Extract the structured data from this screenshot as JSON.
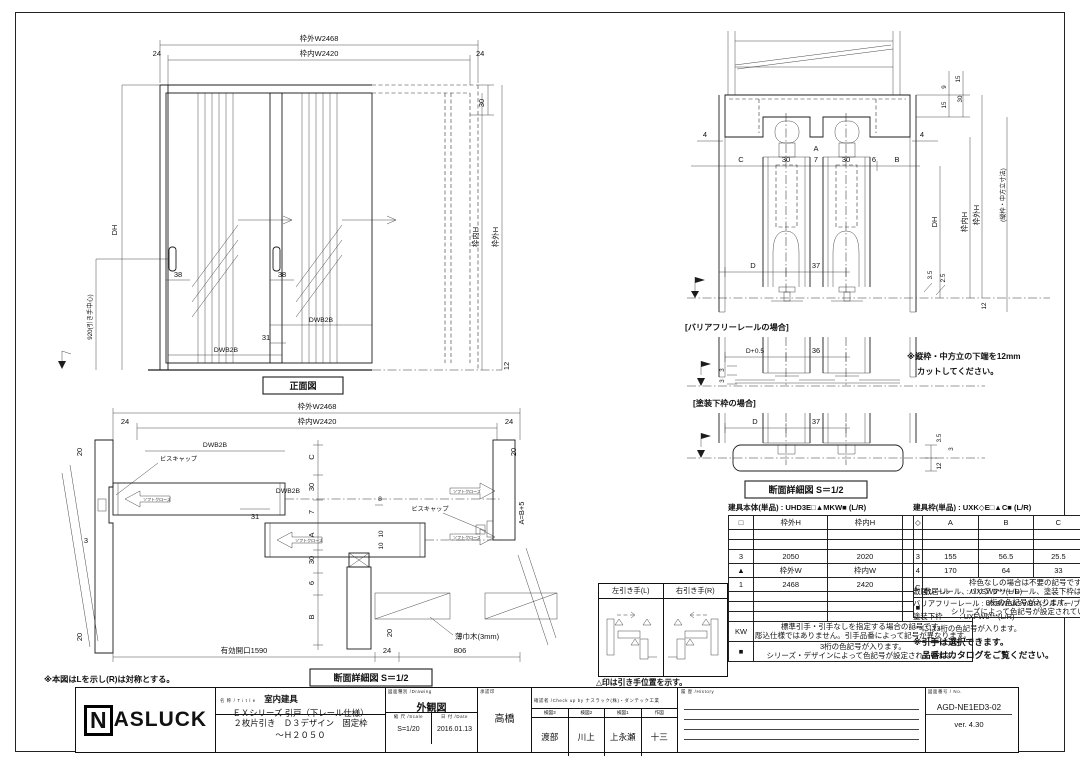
{
  "front": {
    "caption": "正面図",
    "dims": {
      "outer_w": "枠外W2468",
      "inner_w": "枠内W2420",
      "s24": "24",
      "s30": "30",
      "s12": "12",
      "dh": "DH",
      "pull": "920(引き手中心)",
      "s38": "38",
      "s31": "31",
      "dwb": "DWB2B",
      "uchi_h": "枠内H",
      "soto_h": "枠外H"
    }
  },
  "plan": {
    "caption": "断面詳細図 S＝1/2",
    "note": "※本図はLを示し(R)は対称とする。",
    "dims": {
      "outer_w": "枠外W2468",
      "inner_w": "枠内W2420",
      "s24": "24",
      "s20": "20",
      "s3": "3",
      "s31": "31",
      "s8": "8",
      "s10": "10",
      "dwb": "DWB2B",
      "c": "C",
      "t30": "30",
      "t7": "7",
      "a": "A",
      "t6": "6",
      "b": "B",
      "rel": "A=B+5",
      "open": "有効開口1590",
      "s806": "806"
    },
    "labels": {
      "cap": "ビスキャップ",
      "soft": "ソフトクローズ",
      "base": "薄巾木(3mm)"
    }
  },
  "section": {
    "caption": "断面詳細図 S＝1/2",
    "case1": "[バリアフリーレールの場合]",
    "case2": "[塗装下枠の場合]",
    "note1": "※縦枠・中方立の下端を12mm",
    "note2": "カットしてください。",
    "dims": {
      "s9": "9",
      "s15": "15",
      "s30": "30",
      "s4": "4",
      "c": "C",
      "t7": "7",
      "t6": "6",
      "a": "A",
      "b": "B",
      "dh": "DH",
      "uchi_h": "枠内H",
      "soto_h": "枠外H",
      "tate": "(縦枠・中方立寸法)",
      "d": "D",
      "s37": "37",
      "s25": "2.5",
      "s35": "3.5",
      "s12": "12",
      "d05": "D+0.5",
      "s36": "36",
      "s3": "3"
    }
  },
  "handles": {
    "left": "左引き手(L)",
    "right": "右引き手(R)",
    "caption": "△印は引き手位置を示す。"
  },
  "table_a": {
    "title": "建具本体(単品) : UHD3E□▲MKW■ (L/R)",
    "headers": [
      "□",
      "枠外H",
      "枠内H",
      "ＤＨ"
    ],
    "r3": [
      "3",
      "2050",
      "2020",
      "2020"
    ],
    "r4": [
      "▲",
      "枠外W",
      "枠内W",
      "ＤＷ"
    ],
    "r5": [
      "1",
      "2468",
      "2420",
      "826"
    ],
    "kw": "KW",
    "kw_note1": "標準引手・引手なしを指定する場合の記号です。",
    "kw_note2": "彫込仕様ではありません。引手品番によって記号が異なります。",
    "sq": "■",
    "sq_note1": "3桁の色記号が入ります。",
    "sq_note2": "シリーズ・デザインによって色記号が設定されています。"
  },
  "table_b": {
    "title": "建具枠(単品) : UXK◇E□▲C■ (L/R)",
    "headers": [
      "◇",
      "A",
      "B",
      "C",
      "D"
    ],
    "r3": [
      "3",
      "155",
      "56.5",
      "25.5",
      "40.5"
    ],
    "r4": [
      "4",
      "170",
      "64",
      "33",
      "48"
    ],
    "c": "C",
    "c_note1": "枠色なしの場合は不要の記号です。",
    "c_note2": "敷居レール、バリアフリーレール、塗装下枠は含まれません。",
    "sq": "■",
    "sq_note1": "3桁の色記号が入ります。",
    "sq_note2": "シリーズによって色記号が設定されています。"
  },
  "parts": {
    "line1": "敷居レール　　 : UXSW6***(L/R)",
    "line2": "バリアフリーレール : UXBW6ASV/BR(シルバー/ブロンズ)",
    "line3": "塗装下枠　　 : UXFW6***(L/R)",
    "line4": "***には3桁の色記号が入ります。",
    "line5": "※引手は選択できます。",
    "line6": "　品番はカタログをご覧ください。"
  },
  "titleblock": {
    "logo_n": "N",
    "logo_rest": "ASLUCK",
    "name_label": "名 称 / T i t l e",
    "name1": "室内建具",
    "name2": "ＥＸシリーズ 引戸（下レール仕様）",
    "name3": "２枚片引き　Ｄ３デザイン　固定枠",
    "name4": "～Ｈ２０５０",
    "drawing_label": "図面種別 /Drawing",
    "drawing": "外観図",
    "scale_label": "縮 尺 /Scale",
    "scale": "S=1/20",
    "date_label": "日 付 /Date",
    "date": "2016.01.13",
    "approval_label": "承認印",
    "approver": "高橋",
    "check_label": "確認者 /Check up by ナスラック(株)・ダンテック工業",
    "roles": [
      "検図3",
      "検図2",
      "検図1",
      "作図"
    ],
    "names": [
      "渡部",
      "川上",
      "上永瀬",
      "十三"
    ],
    "history_label": "履 歴 /History",
    "no_label": "図面番号 / No.",
    "no": "AGD-NE1ED3-02",
    "version": "ver. 4.30"
  }
}
